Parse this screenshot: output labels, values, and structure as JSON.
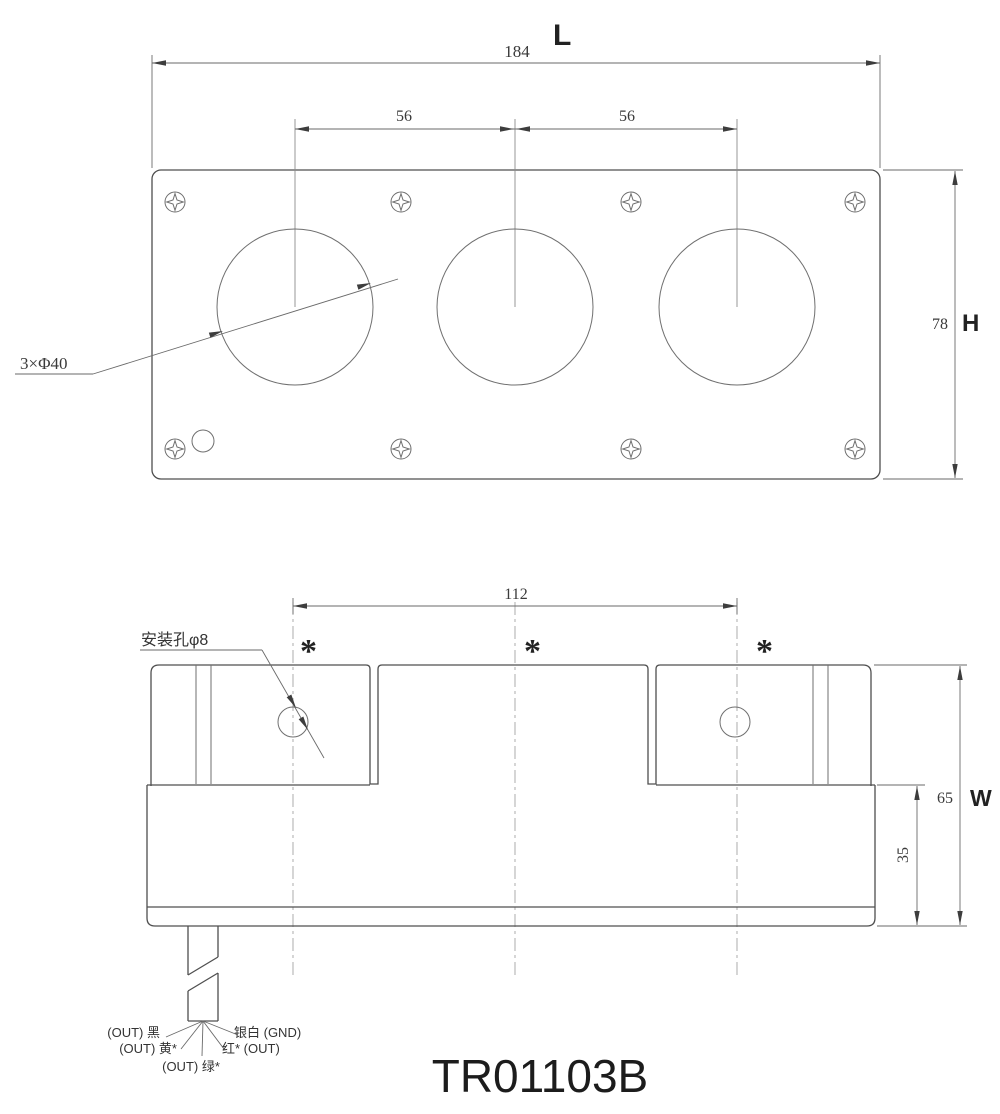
{
  "title": "TR01103B",
  "top_view": {
    "length_dim": "184",
    "length_letter": "L",
    "spacing_dim_left": "56",
    "spacing_dim_right": "56",
    "height_dim": "78",
    "height_letter": "H",
    "hole_callout": "3×Φ40"
  },
  "bottom_view": {
    "mount_spacing_dim": "112",
    "mount_hole_callout": "安装孔φ8",
    "phase_markers": [
      "*",
      "*",
      "*"
    ],
    "width_dim": "65",
    "width_letter": "W",
    "base_dim": "35",
    "wire_labels": {
      "black": "(OUT) 黑",
      "yellow": "(OUT) 黄*",
      "green": "(OUT) 绿*",
      "silver": "银白 (GND)",
      "red": "红* (OUT)"
    }
  }
}
